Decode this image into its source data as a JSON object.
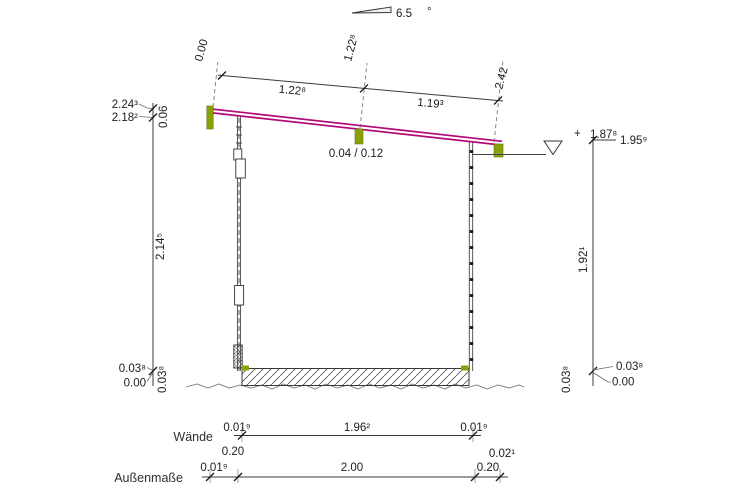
{
  "colors": {
    "roof_magenta": "#b3097a",
    "wood_green": "#8aa10a",
    "line_dark": "#3a3a3a"
  },
  "slope_indicator": {
    "value": "6.5",
    "unit": "°"
  },
  "roof_dimension": {
    "origin": "0.00",
    "mid_offset": "1.22⁸",
    "end_offset": "2.42",
    "segment_left": "1.22⁸",
    "segment_right": "1.19³"
  },
  "purlin_label": "0.04 / 0.12",
  "left_heights": {
    "top_outer": "2.24³",
    "top_inner": "2.18²",
    "fascia_height": "0.06",
    "wall_height": "2.14⁵",
    "plinth_top": "0.03⁸",
    "ground": "0.00",
    "plinth_height": "0.03⁸"
  },
  "right_heights": {
    "level_sign": "+",
    "level_value": "1.87⁸",
    "top": "1.95⁹",
    "wall_height": "1.92¹",
    "plinth_height": "0.03⁸",
    "plinth_top": "0.03⁸",
    "ground": "0.00"
  },
  "walls_row": {
    "label": "Wände",
    "left_wall": "0.01⁹",
    "clear_width": "1.96²",
    "right_wall": "0.01⁹",
    "left_extra": "0.20",
    "right_extra": "0.02¹"
  },
  "outer_row": {
    "label": "Außenmaße",
    "left": "0.01⁹",
    "total": "2.00",
    "right": "0.20"
  }
}
